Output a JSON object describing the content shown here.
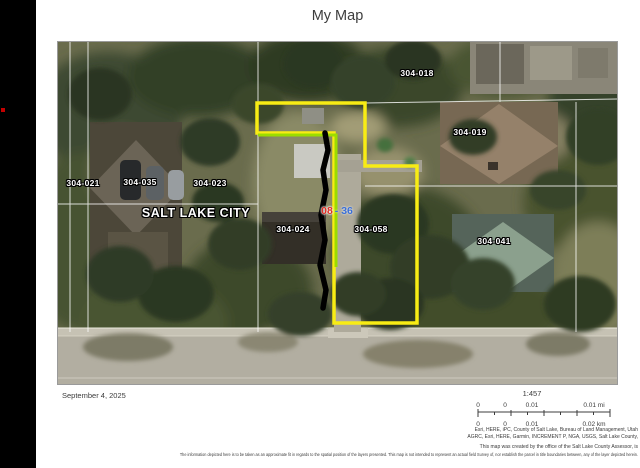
{
  "page": {
    "title": "My Map",
    "date": "September 4, 2025"
  },
  "map": {
    "city_label": "SALT LAKE CITY",
    "parcels": [
      {
        "id": "304-021"
      },
      {
        "id": "304-035"
      },
      {
        "id": "304-023"
      },
      {
        "id": "304-018"
      },
      {
        "id": "304-019"
      },
      {
        "id": "304-024"
      },
      {
        "id": "304-058"
      },
      {
        "id": "304-041"
      }
    ],
    "selection_tag": {
      "red": "08",
      "blue": "- 36"
    },
    "colors": {
      "parcel_outline_yellow": "#f8ec14",
      "measure_line_green": "#9bdc00",
      "drawn_line_black": "#000000",
      "parcel_boundaries_white": "#ffffff",
      "selection_red": "#dd2e23",
      "selection_blue": "#3a6fd8",
      "red_marker_dot": "#c40000"
    }
  },
  "scalebar": {
    "ratio": "1:457",
    "top": [
      "0",
      "0",
      "0.01",
      "0.01 mi"
    ],
    "bottom": [
      "0",
      "0",
      "0.01",
      "0.02 km"
    ]
  },
  "credits": {
    "line1": "Esri, HERE, iPC, County of Salt Lake, Bureau of Land Management, Utah",
    "line2": "AGRC, Esri, HERE, Garmin, INCREMENT P, NGA, USGS, Salt Lake County,"
  },
  "disclaimer": {
    "line1": "This map was created by the office of the Salt Lake County Assessor, is",
    "line2": "The information depicted here is to be taken as an approximate fit in regards to the spatial position of the layers presented. This map is not intended to represent an actual field Survey of, nor establish the parcel in title boundaries between, any of the layer depicted herein."
  }
}
